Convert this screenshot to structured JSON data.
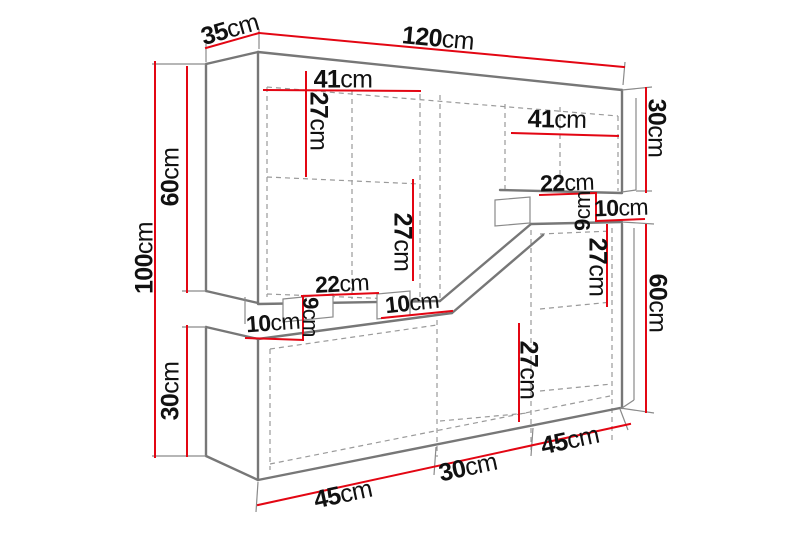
{
  "unit": "cm",
  "colors": {
    "dimension_red": "#e30613",
    "outline_gray": "#777777",
    "hidden_edge_gray": "#9a9a9a",
    "text": "#111111",
    "background": "#ffffff"
  },
  "measurements": {
    "overall_width": 120,
    "overall_depth": 35,
    "overall_height": 100,
    "left_upper_section_height": 60,
    "left_lower_section_height": 30,
    "right_upper_section_height": 30,
    "right_lower_section_height": 60,
    "bottom_section_widths": [
      45,
      30,
      45
    ],
    "interior_widths": [
      41,
      41
    ],
    "shelf_offsets": [
      27,
      27,
      27,
      27
    ],
    "niche_heights": [
      9,
      9
    ],
    "niche_widths": [
      22,
      22,
      10,
      10,
      10
    ]
  },
  "labels": [
    {
      "id": "top-depth",
      "num": "35",
      "unit": "cm"
    },
    {
      "id": "top-width",
      "num": "120",
      "unit": "cm"
    },
    {
      "id": "left-total-height",
      "num": "100",
      "unit": "cm"
    },
    {
      "id": "left-upper-height",
      "num": "60",
      "unit": "cm"
    },
    {
      "id": "left-lower-height",
      "num": "30",
      "unit": "cm"
    },
    {
      "id": "upper-left-interior-width",
      "num": "41",
      "unit": "cm"
    },
    {
      "id": "upper-left-shelf",
      "num": "27",
      "unit": "cm"
    },
    {
      "id": "upper-right-interior-width",
      "num": "41",
      "unit": "cm"
    },
    {
      "id": "right-upper-height",
      "num": "30",
      "unit": "cm"
    },
    {
      "id": "right-niche-width",
      "num": "22",
      "unit": "cm"
    },
    {
      "id": "right-niche-height",
      "num": "9",
      "unit": "cm"
    },
    {
      "id": "right-niche-depth",
      "num": "10",
      "unit": "cm"
    },
    {
      "id": "lower-right-shelf",
      "num": "27",
      "unit": "cm"
    },
    {
      "id": "right-lower-height",
      "num": "60",
      "unit": "cm"
    },
    {
      "id": "mid-niche-width",
      "num": "22",
      "unit": "cm"
    },
    {
      "id": "mid-niche-height",
      "num": "9",
      "unit": "cm"
    },
    {
      "id": "left-niche-depth",
      "num": "10",
      "unit": "cm"
    },
    {
      "id": "mid-niche-depth",
      "num": "10",
      "unit": "cm"
    },
    {
      "id": "upper-left-lower-shelf",
      "num": "27",
      "unit": "cm"
    },
    {
      "id": "lower-mid-shelf",
      "num": "27",
      "unit": "cm"
    },
    {
      "id": "bottom-left-width",
      "num": "45",
      "unit": "cm"
    },
    {
      "id": "bottom-mid-width",
      "num": "30",
      "unit": "cm"
    },
    {
      "id": "bottom-right-width",
      "num": "45",
      "unit": "cm"
    }
  ]
}
